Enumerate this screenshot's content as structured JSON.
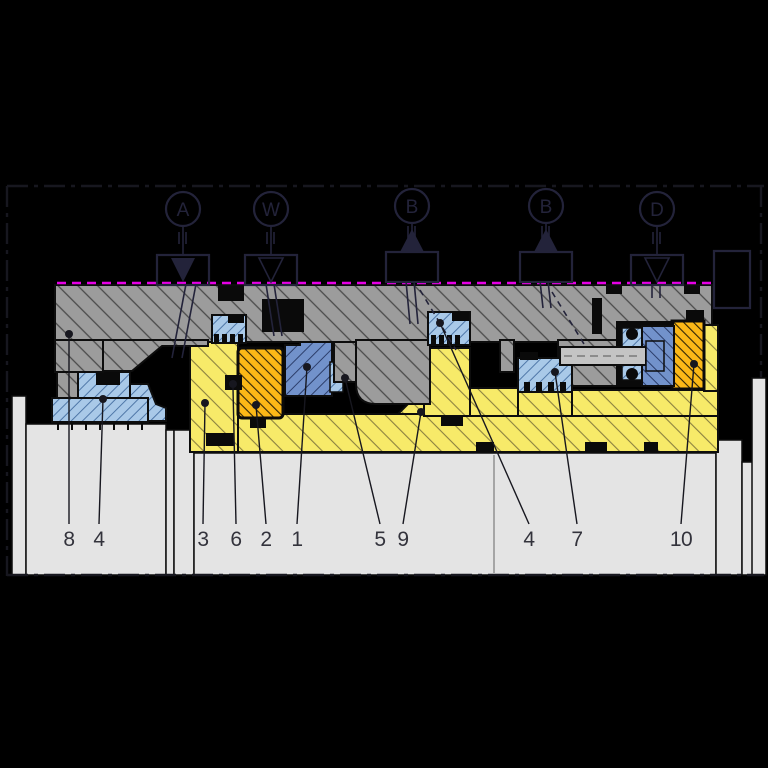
{
  "diagram": {
    "kind": "mechanical-seal-cartridge-cross-section",
    "ports": [
      {
        "label": "A",
        "symbol": "filled-triangle-down"
      },
      {
        "label": "W",
        "symbol": "open-triangle-down"
      },
      {
        "label": "B",
        "symbol": "filled-triangle-up"
      },
      {
        "label": "B",
        "symbol": "filled-triangle-up"
      },
      {
        "label": "D",
        "symbol": "open-triangle-down"
      }
    ],
    "callouts": [
      {
        "number": "8"
      },
      {
        "number": "4"
      },
      {
        "number": "3"
      },
      {
        "number": "6"
      },
      {
        "number": "2"
      },
      {
        "number": "1"
      },
      {
        "number": "5"
      },
      {
        "number": "9"
      },
      {
        "number": "4"
      },
      {
        "number": "7"
      },
      {
        "number": "10"
      }
    ],
    "colors": {
      "bg": "#000000",
      "outline": "#0d0d0d",
      "symbol": "#23233a",
      "housing": "#9c9c9c",
      "shaft": "#e4e4e4",
      "sleeve": "#f7ea69",
      "collar": "#fcb817",
      "face": "#7292cb",
      "elastomer": "#a9c9e8",
      "magenta": "#e600e6",
      "label": "#33333c",
      "leader": "#17171f"
    }
  }
}
